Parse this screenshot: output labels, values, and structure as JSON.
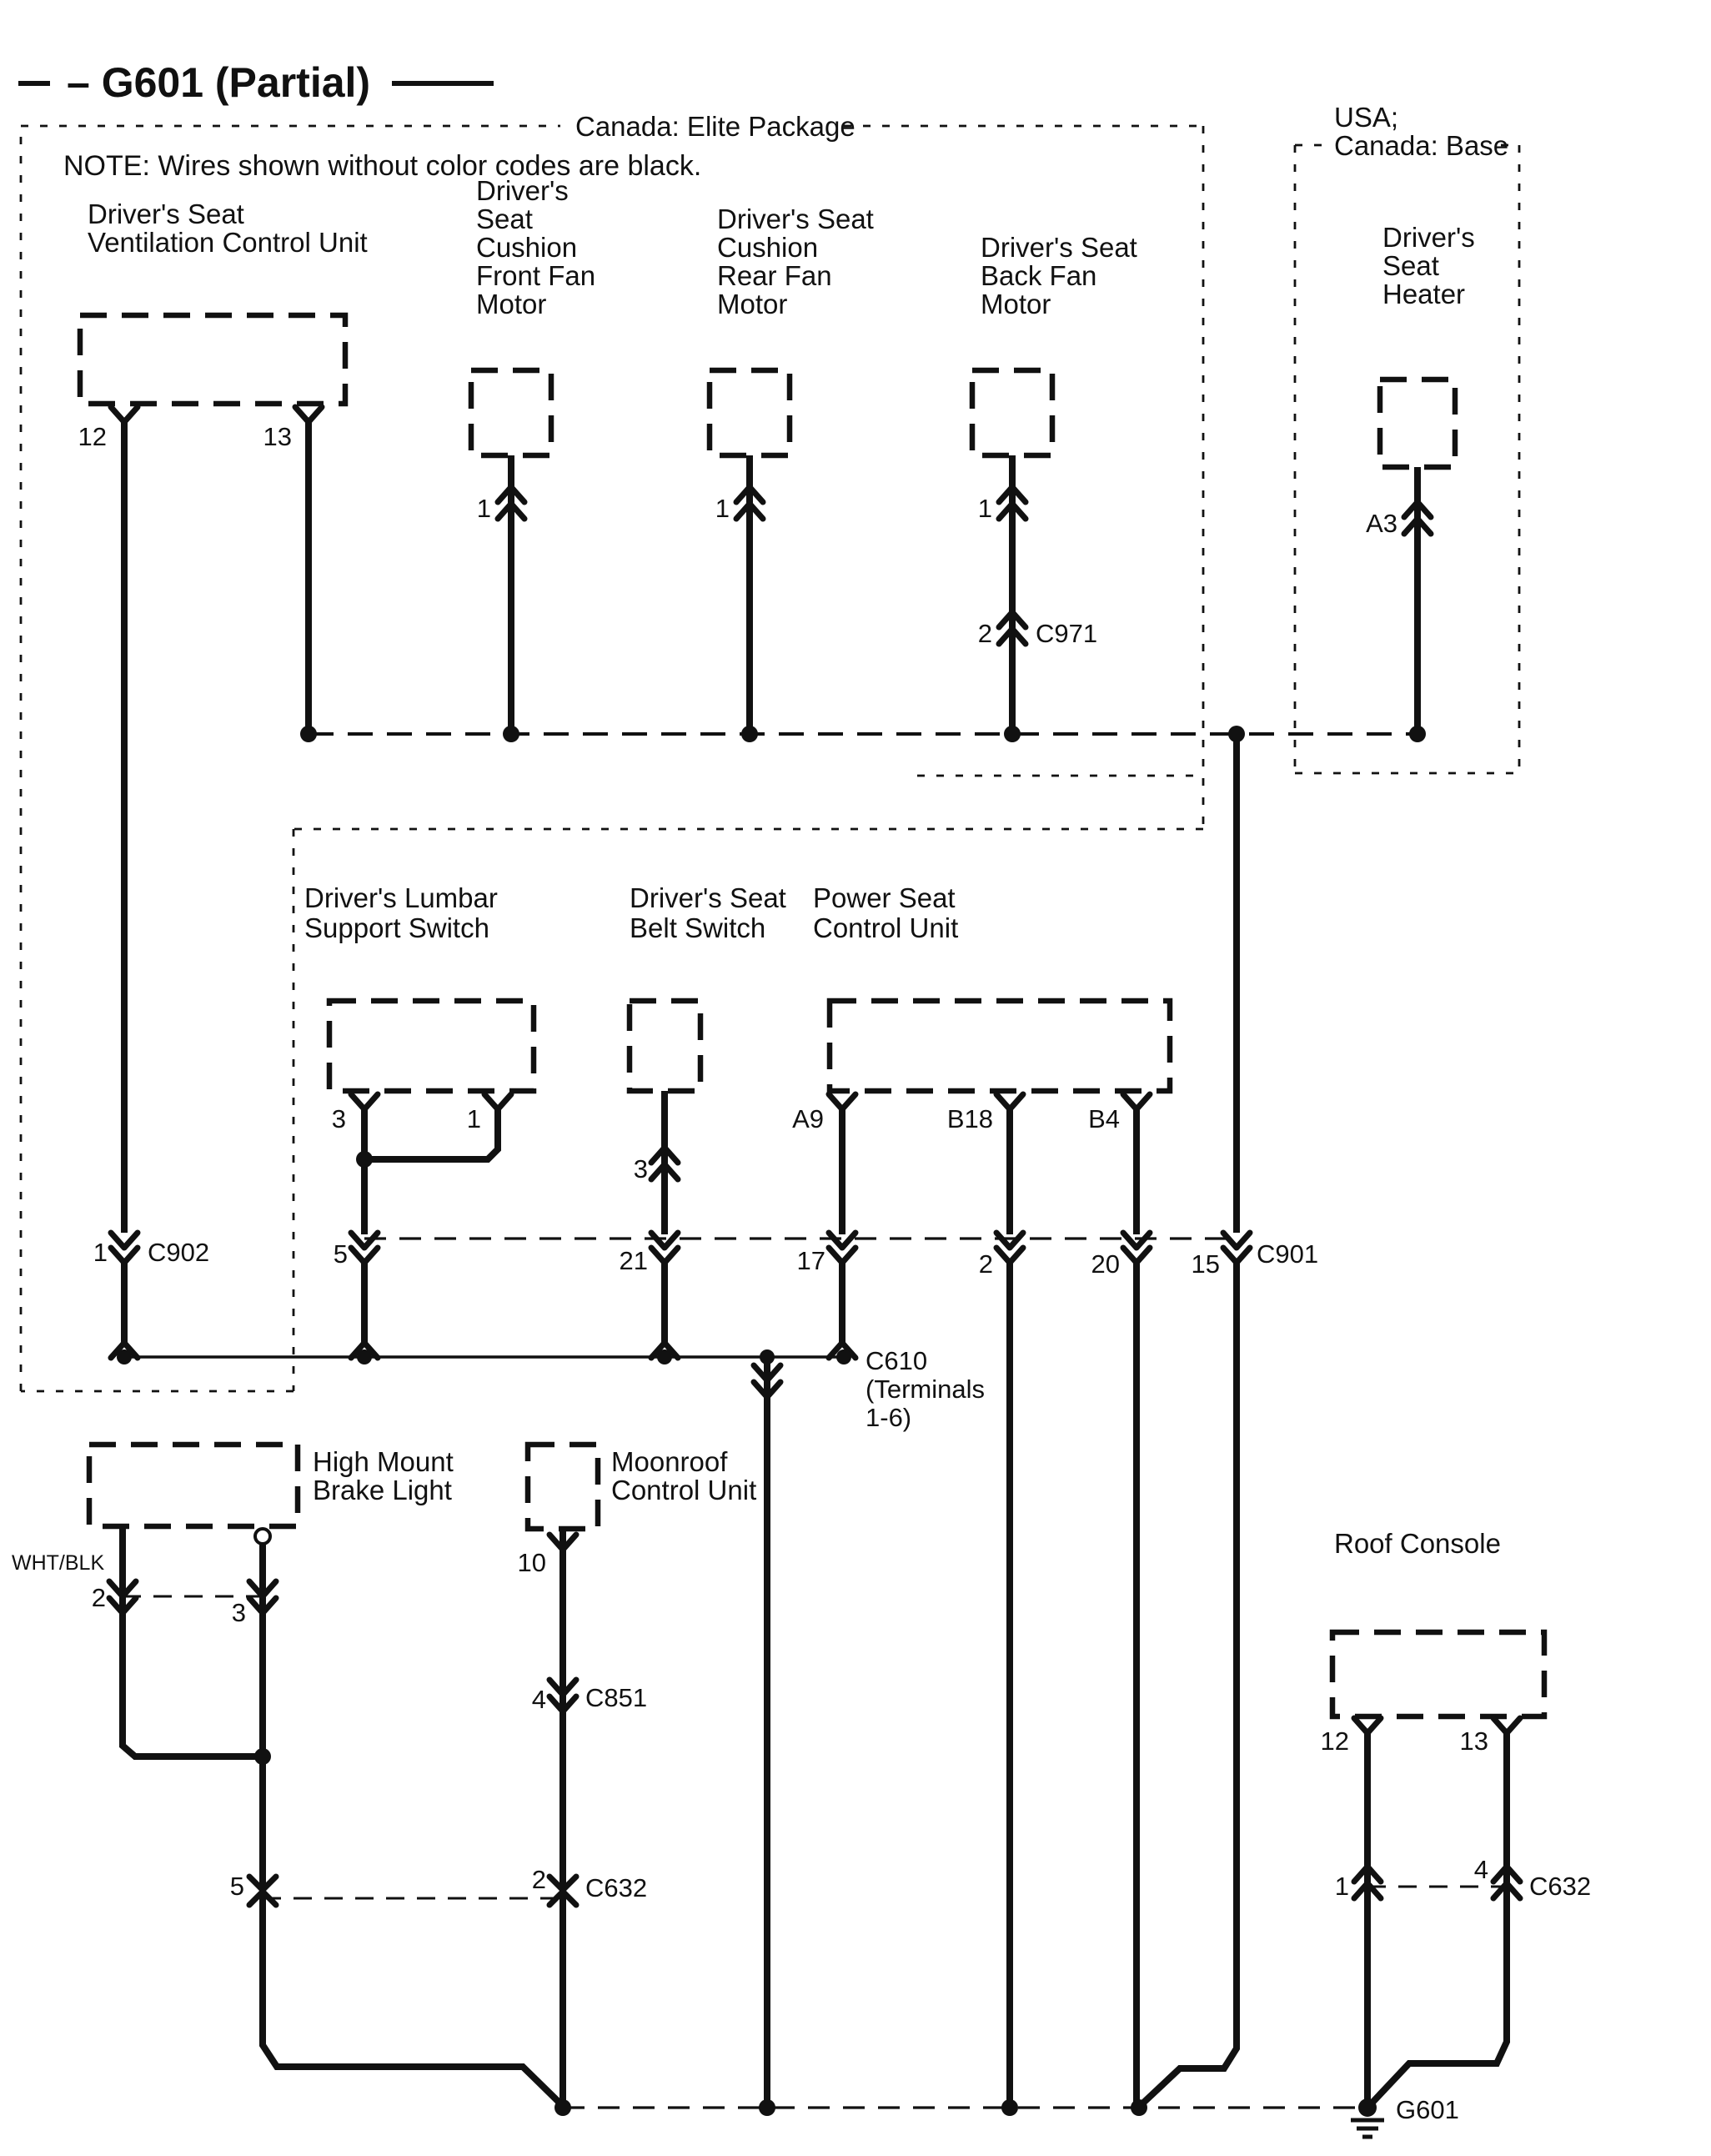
{
  "title": "– G601 (Partial)",
  "note": "NOTE: Wires shown without color codes are black.",
  "regions": {
    "elite": "Canada: Elite Package",
    "usa_line1": "USA;",
    "usa_line2": "Canada: Base"
  },
  "components": {
    "vent": {
      "l1": "Driver's Seat",
      "l2": "Ventilation Control Unit",
      "pin12": "12",
      "pin13": "13"
    },
    "front_fan": {
      "l1": "Driver's",
      "l2": "Seat",
      "l3": "Cushion",
      "l4": "Front Fan",
      "l5": "Motor",
      "pin1": "1"
    },
    "rear_fan": {
      "l1": "Driver's Seat",
      "l2": "Cushion",
      "l3": "Rear Fan",
      "l4": "Motor",
      "pin1": "1"
    },
    "back_fan": {
      "l1": "Driver's Seat",
      "l2": "Back Fan",
      "l3": "Motor",
      "pin1": "1",
      "pin2": "2"
    },
    "heater": {
      "l1": "Driver's",
      "l2": "Seat",
      "l3": "Heater",
      "pinA3": "A3"
    },
    "lumbar": {
      "l1": "Driver's Lumbar",
      "l2": "Support Switch",
      "pin3": "3",
      "pin1": "1",
      "pin5": "5"
    },
    "belt": {
      "l1": "Driver's Seat",
      "l2": "Belt Switch",
      "pin3": "3",
      "pin21": "21"
    },
    "power": {
      "l1": "Power Seat",
      "l2": "Control Unit",
      "pinA9": "A9",
      "pinB18": "B18",
      "pinB4": "B4",
      "pin17": "17",
      "pin2": "2",
      "pin20": "20"
    },
    "brake": {
      "l1": "High Mount",
      "l2": "Brake Light",
      "wire_color": "WHT/BLK",
      "pin2": "2",
      "pin3": "3",
      "pin5": "5"
    },
    "moonroof": {
      "l1": "Moonroof",
      "l2": "Control Unit",
      "pin10": "10",
      "pin4": "4",
      "pin2": "2"
    },
    "roof": {
      "l1": "Roof Console",
      "pin12": "12",
      "pin13": "13",
      "pin1": "1",
      "pin4": "4"
    }
  },
  "connectors": {
    "c902_pin": "1",
    "c902": "C902",
    "c901_pin": "15",
    "c901": "C901",
    "c971": "C971",
    "c851": "C851",
    "c632": "C632",
    "c610_l1": "C610",
    "c610_l2": "(Terminals",
    "c610_l3": "1-6)",
    "ground": "G601"
  }
}
